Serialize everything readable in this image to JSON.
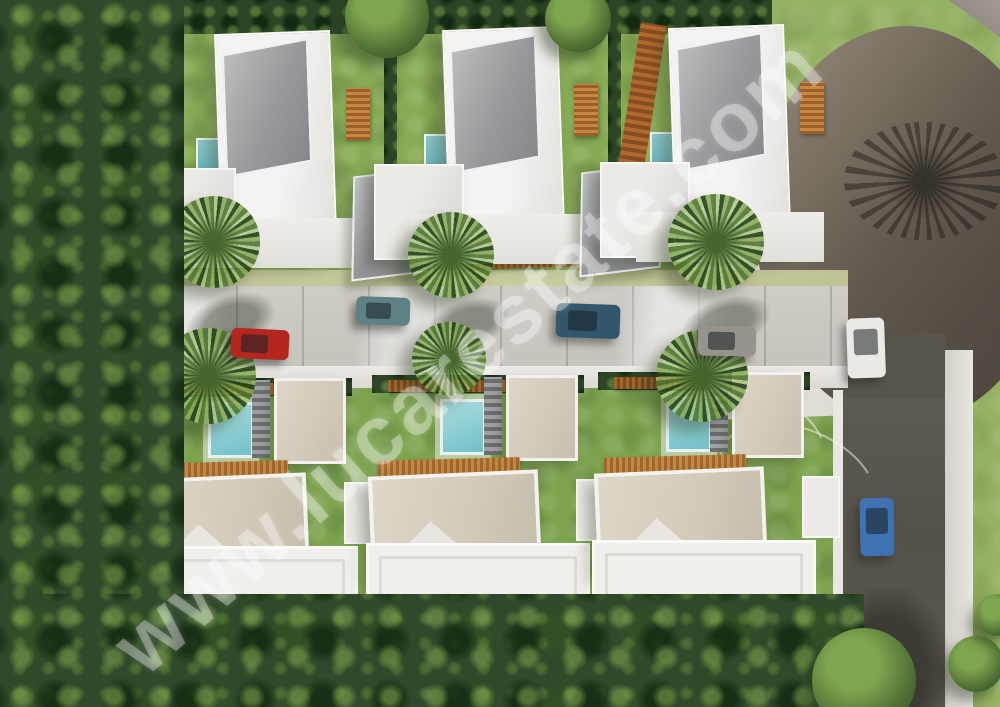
{
  "scene": {
    "type": "3d-aerial-architectural-render",
    "subject": "Residential development of six detached modern white villas with private turquoise pools",
    "view": "top-down aerial",
    "villas_total": 6,
    "rows": [
      {
        "name": "north-row",
        "villas": 3
      },
      {
        "name": "south-row",
        "villas": 3
      }
    ],
    "features": [
      "central light paved street with parked cars",
      "dark asphalt cul-de-sac turning circle at top right with palm shadow",
      "asphalt side road running down the right edge",
      "dense tree canopy along left and bottom edges",
      "hedges, wooden pergolas and palm trees along the street",
      "small turquoise swimming pools in each villa plot"
    ]
  },
  "watermark": {
    "text": "www.lucarestate.com",
    "color": "#ffffff",
    "opacity": 0.33,
    "angle_deg": -41.5
  },
  "palette": {
    "lawn": "#95b163",
    "garden": "#87aa55",
    "forest_dark": "#30492a",
    "forest_light": "#7ea550",
    "street_paving": "#cfccc6",
    "street_verge": "#c2c49a",
    "sidewalk": "#eceae6",
    "asphalt": "#5e5952",
    "asphalt_shadow": "#49443d",
    "roof_white": "#f0efeb",
    "roof_grey": "#97989b",
    "roof_beige": "#d2cab9",
    "pool_teal": "#72c0c7",
    "pergola_wood": "#a3652e"
  },
  "cars": [
    {
      "name": "red-car",
      "color": "#b3271f",
      "location": "street west end",
      "orientation": "horizontal"
    },
    {
      "name": "teal-car",
      "color": "#5d8184",
      "location": "street west-centre",
      "orientation": "horizontal"
    },
    {
      "name": "navy-car",
      "color": "#32566b",
      "location": "street centre",
      "orientation": "horizontal"
    },
    {
      "name": "grey-car",
      "color": "#96948c",
      "location": "street east end",
      "orientation": "horizontal"
    },
    {
      "name": "white-car",
      "color": "#eae9e5",
      "location": "side road north",
      "orientation": "vertical"
    },
    {
      "name": "blue-car",
      "color": "#3e72b0",
      "location": "side road south",
      "orientation": "vertical"
    }
  ]
}
